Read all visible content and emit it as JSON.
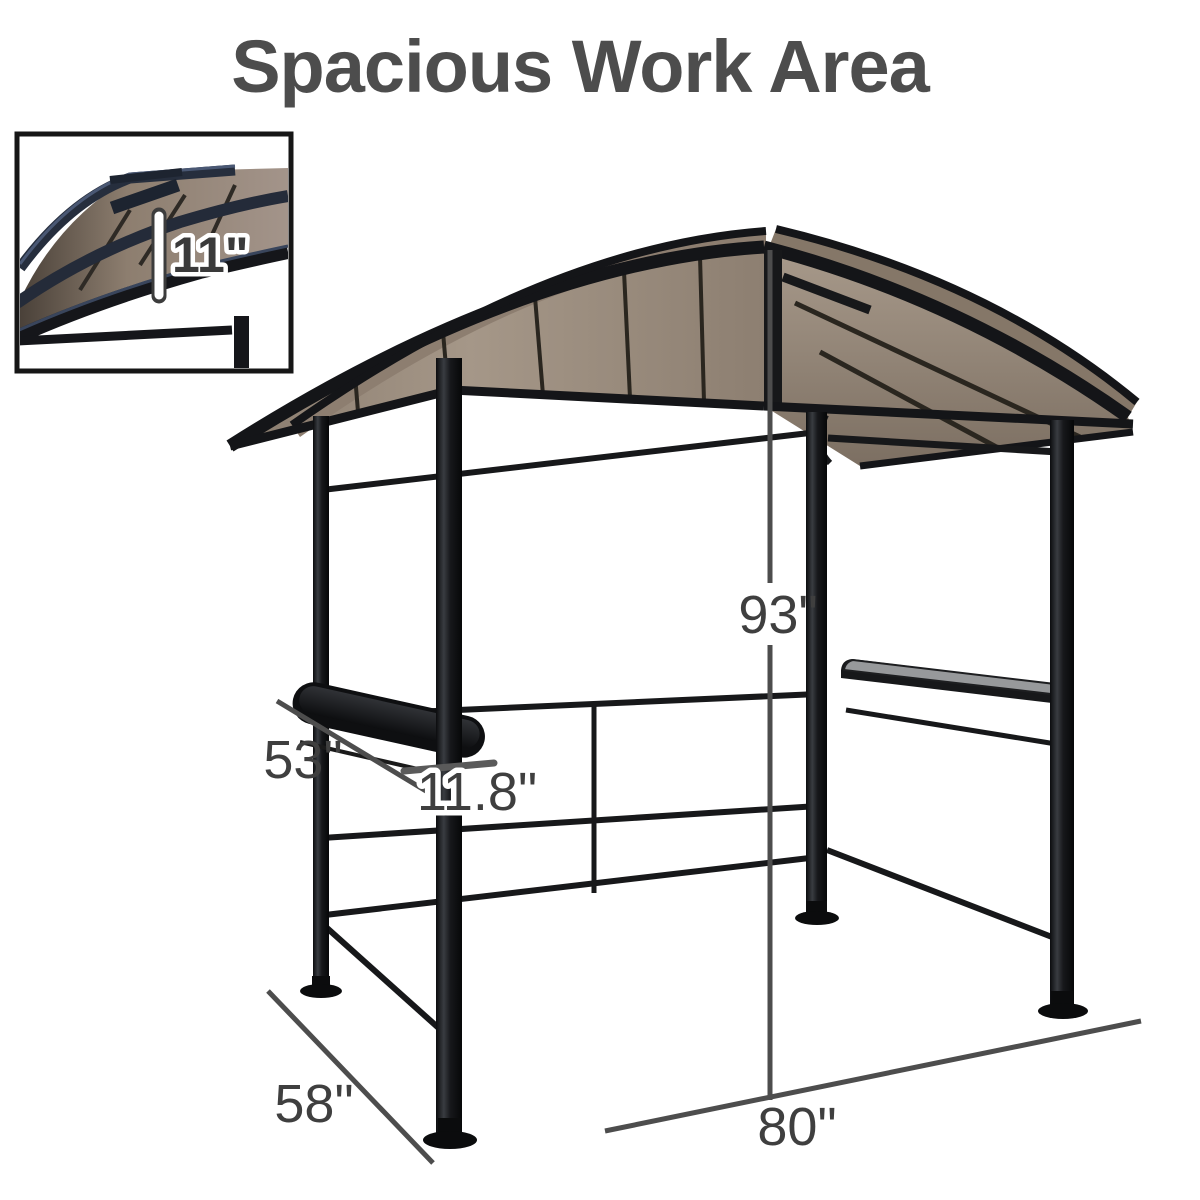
{
  "title": "Spacious Work Area",
  "dimensions": {
    "height": "93\"",
    "front_width": "80\"",
    "side_depth": "58\"",
    "shelf_length": "53\"",
    "shelf_depth": "11.8\"",
    "roof_tier_gap": "11\""
  },
  "colors": {
    "title_text": "#4d4d4d",
    "dimension_text": "#3f3f3f",
    "dimension_line": "#4d4d4d",
    "frame_metal": "#141518",
    "roof_panel_tan": "#98887a",
    "inset_roof_navy": "#2a3346",
    "shelf_top_gray": "#97999b"
  }
}
